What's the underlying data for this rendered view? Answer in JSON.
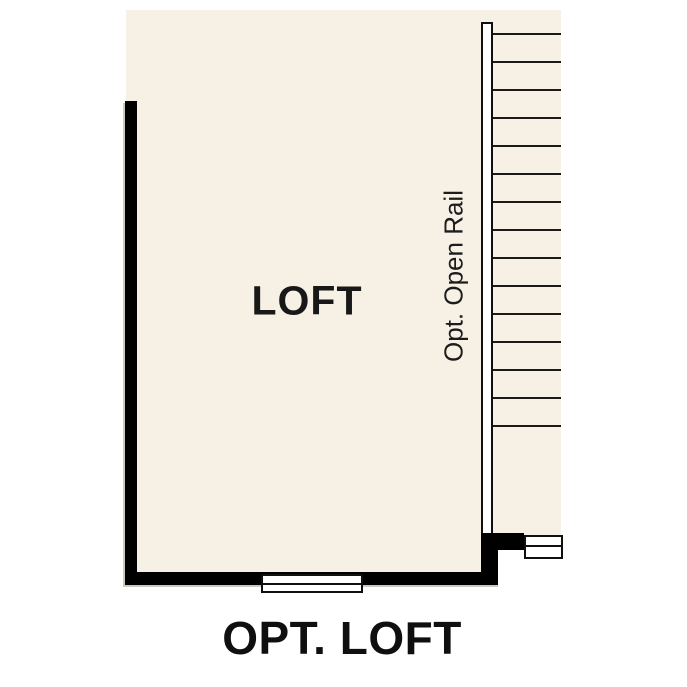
{
  "caption": "OPT. LOFT",
  "loft": {
    "label": "LOFT"
  },
  "stairs": {
    "rail_label": "Opt. Open Rail",
    "tread_count": 15
  },
  "colors": {
    "background": "#ffffff",
    "floor": "#f6f0e5",
    "wall": "#000000",
    "tread_line": "#1a1a1a"
  }
}
